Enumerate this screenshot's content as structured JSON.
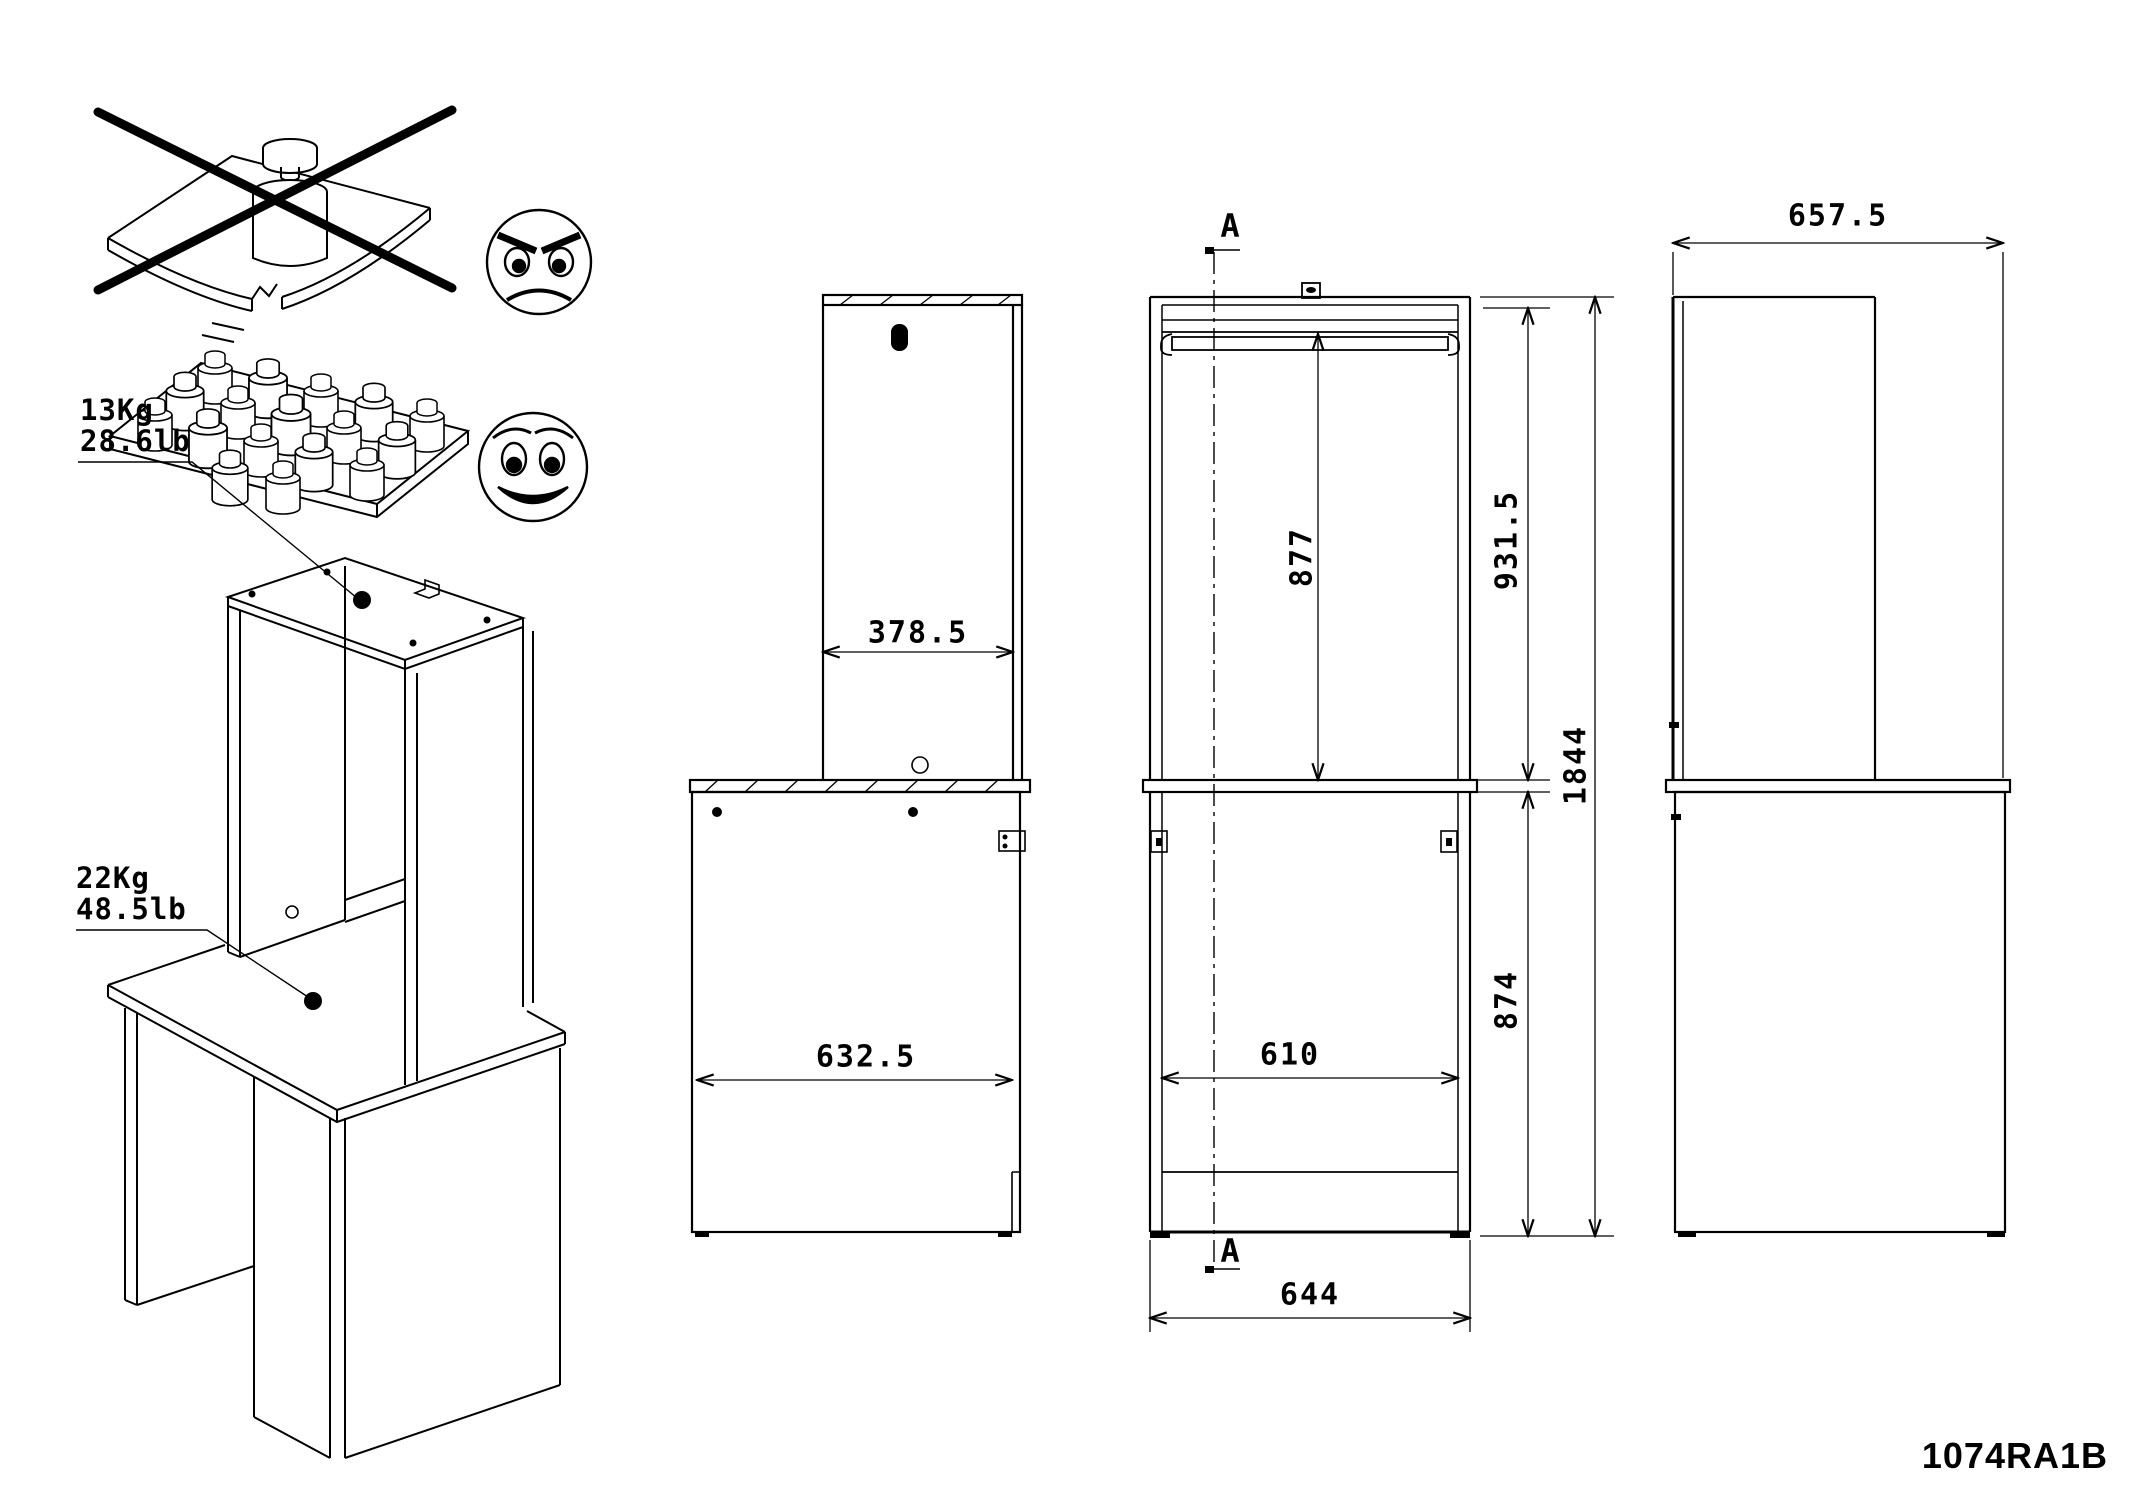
{
  "page": {
    "background": "#ffffff",
    "line_color": "#000000"
  },
  "warnings": {
    "bad_icon": "single-heavy-weight-bending-shelf-crossed-out",
    "bad_face": "angry-face",
    "good_icon": "many-small-weights-distributed-on-shelf",
    "good_face": "smiley-face"
  },
  "iso_labels": {
    "hutch_load_kg": "13Kg",
    "hutch_load_lb": "28.6lb",
    "desk_load_kg": "22Kg",
    "desk_load_lb": "48.5lb"
  },
  "section": {
    "marker_top": "A",
    "marker_bottom": "A"
  },
  "dimensions": {
    "hutch_depth": "378.5",
    "desk_side_depth": "632.5",
    "rail_to_desk": "877",
    "hutch_height": "931.5",
    "total_height": "1844",
    "desk_to_floor": "874",
    "inner_width": "610",
    "outer_width": "644",
    "desk_top_depth": "657.5"
  },
  "footer": {
    "part_number": "1074RA1B"
  }
}
